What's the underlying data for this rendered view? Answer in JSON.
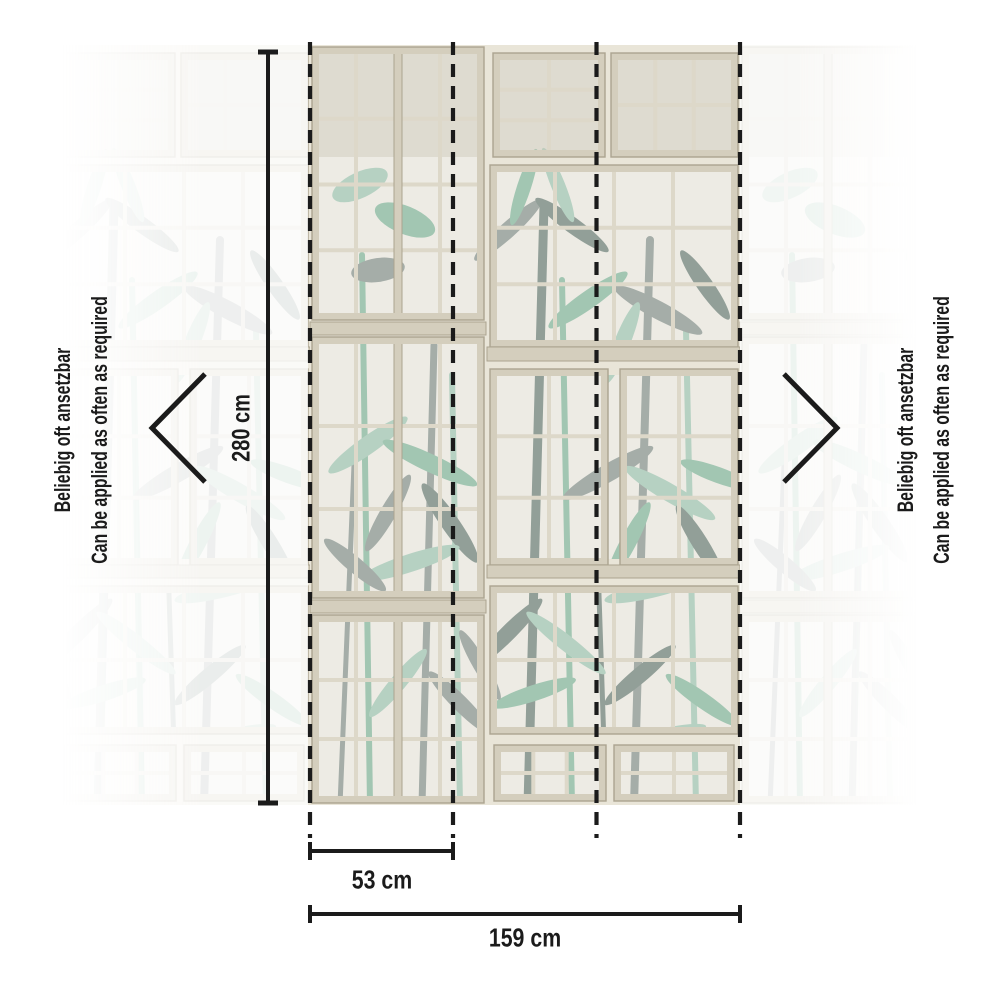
{
  "labels": {
    "note_de": "Beliebig oft ansetzbar",
    "note_en": "Can be applied as often as required",
    "height": "280 cm",
    "strip_width": "53 cm",
    "total_width": "159 cm"
  },
  "icons": {
    "left_arrow": "chevron-left-icon",
    "right_arrow": "chevron-right-icon"
  },
  "palette": {
    "ink": "#1b1b1b",
    "wall": "#e9e5d8",
    "frame": "#d4cebd",
    "frame-2": "#ddd8c9",
    "frame-edge": "#aba490",
    "glass": "#edebe4",
    "glass-shade": "#cbc5b4",
    "plant-green": "#b6d1c2",
    "plant-green-2": "#a2c6b2",
    "plant-gray": "#a5ada8",
    "plant-gray-2": "#929f98"
  }
}
